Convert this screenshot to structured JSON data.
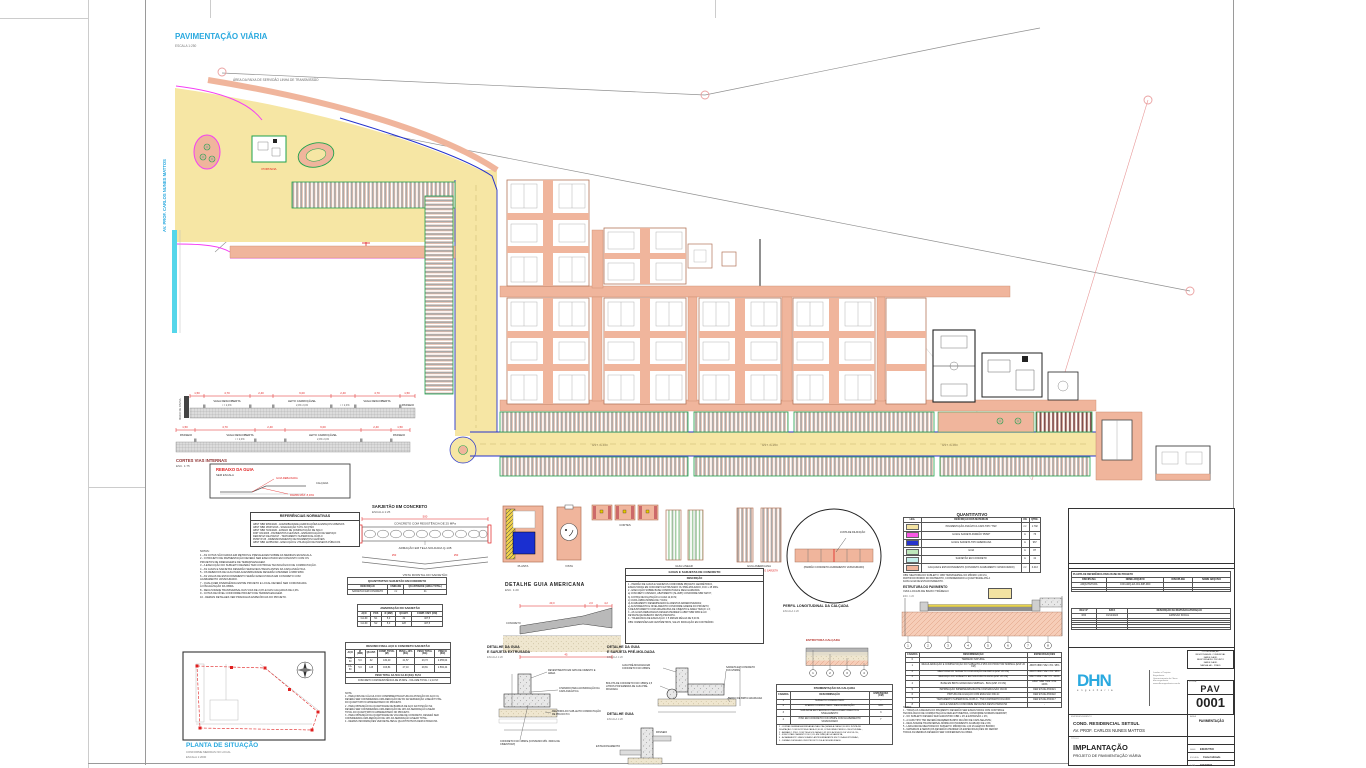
{
  "plan": {
    "title": "PAVIMENTAÇÃO VIÁRIA",
    "scale": "ESCALA 1:250",
    "servidao": "ÁREA DA FAIXA DE SERVIDÃO LINHA DE TRANSMISSÃO",
    "street": "AV. PROF. CARLOS NUNES MATTOS",
    "portaria": "PORTARIA",
    "stations": [
      "EST. 0+100",
      "EST. 0+200",
      "EST. 0+300"
    ]
  },
  "cortes": {
    "title": "CORTES VIAS INTERNAS",
    "scale": "ESC. 1:75",
    "muro": "MURO DE DIVISA",
    "s1_dims": [
      "1,50",
      "4,70",
      "2,40",
      "6,00",
      "2,40",
      "4,70",
      "1,50"
    ],
    "s1_labels": [
      "VAGA DESCOBERTA",
      "LEITO CARROÇÁVEL",
      "VAGA DESCOBERTA",
      "PASSEIO"
    ],
    "s1_slopes": [
      "i = 2,0%",
      "2,0%   2,0%",
      "i = 2,0%"
    ],
    "s2_dims": [
      "1,50",
      "4,70",
      "2,40",
      "6,00",
      "2,40",
      "1,50"
    ],
    "s2_labels": [
      "PASSEIO",
      "VAGA DESCOBERTA",
      "LEITO CARROÇÁVEL",
      "PASSEIO"
    ],
    "s2_slopes": [
      "i = 2,0%",
      "2,0%   2,0%"
    ]
  },
  "rebaixo": {
    "title": "REBAIXO DA GUIA",
    "scale": "SEM ESCALA",
    "l1": "GUIA REBAIXADA",
    "l2": "RAMPA MÁX. 8,33%",
    "l3": "CALÇADA"
  },
  "normas": {
    "title": "REFERÊNCIAS NORMATIVAS",
    "lines": [
      "ABNT NBR 9050/2020 - ACESSIBILIDADE A EDIFICAÇÕES E ESPAÇOS URBANOS",
      "ABNT NBR 16537/2016 - SINALIZAÇÃO TÁTIL NO PISO",
      "ABNT NBR 7182/2020 - ENSAIO DE COMPACTAÇÃO DE SOLO",
      "DNIT 031/2006 - PAVIMENTOS FLEXÍVEIS - ESPECIFICAÇÃO DE SERVIÇO",
      "DER/SP ET-DE-P00/017 - TRATAMENTO SUPERFICIAL DUPLO",
      "PMSP IP-05 - DIMENSIONAMENTO DE PAVIMENTOS FLEXÍVEIS",
      "ABNT NBR 12255/1990 - EXECUÇÃO E UTILIZAÇÃO DE PASSEIOS PÚBLICOS"
    ]
  },
  "notas": {
    "lines": [
      "NOTAS:",
      "1 - AS COTAS SÃO DADAS EM METROS E PREVALECEM SOBRE AS MEDIDAS EM ESCALA.",
      "2 - O PROJETO DE PAVIMENTAÇÃO DEVERÁ SER EXECUTADO EM CONJUNTO COM OS",
      "PROJETOS DE DRENAGEM E DE TERRAPLENAGEM.",
      "3 - A EXECUÇÃO DO SUBLEITO DEVERÁ TER CONTROLE TECNOLÓGICO DE COMPACTAÇÃO.",
      "4 - AS GUIAS E SARJETAS DEVERÃO SER EXECUTADAS ANTES DA CAPA ASFÁLTICA.",
      "5 - OS REBAIXOS DE GUIA PARA ACESSIBILIDADE DEVERÃO ATENDER À NBR 9050.",
      "6 - AS VAGAS DE ESTACIONAMENTO SERÃO EXECUTADAS EM CONCRETO COM",
      "ACABAMENTO VASSOURADO.",
      "7 - QUALQUER DIVERGÊNCIA ENTRE PROJETO E LOCAL DEVERÁ SER COMUNICADA",
      "À FISCALIZAÇÃO DA OBRA.",
      "8 - DECLIVIDADE TRANSVERSAL DAS VIAS DE 2,0% E DAS CALÇADAS DE 2,0%.",
      "9 - COTAS DE NÍVEL CONFORME PROJETO DE TERRAPLENAGEM.",
      "10 - DEMAIS DETALHES VER PRANCHAS ESPECÍFICAS DO PROJETO."
    ]
  },
  "situacao": {
    "title": "PLANTA DE SITUAÇÃO",
    "sub1": "CONFORME MEDIDAS NO LOCAL",
    "sub2": "ESCALA 1:2000"
  },
  "sarjetao": {
    "title": "SARJETÃO EM CONCRETO",
    "scale": "ESCALA 1:25",
    "mat": "CONCRETO COM RESISTÊNCIA DE 25 MPa",
    "arm": "ARMAÇÃO EM TELA SOLDADA Q-138",
    "vista": "VISTA FRONTAL DO SARJETÃO",
    "dim": "500",
    "dim2": "250",
    "dim3": "250",
    "quant": {
      "title": "QUANTITATIVO SARJETÃO EM CONCRETO",
      "cols": [
        "DESCRIÇÃO",
        "UNIDADE",
        "QUANTIDADE (ÁREA TOTAL)"
      ],
      "rows": [
        [
          "SARJETÃO EM CONCRETO",
          "m²",
          "41"
        ]
      ]
    },
    "amarracao": {
      "title": "AMARRAÇÃO DO SARJETÃO",
      "cols": [
        "AÇO",
        "POS",
        "Ø (MM)",
        "QUANT.",
        "COMP. UNIT. (CM)"
      ],
      "rows": [
        [
          "CA-60",
          "N1",
          "5,0",
          "32",
          "407,5"
        ],
        [
          "CA-60",
          "N2",
          "5,0",
          "128",
          "407,5"
        ]
      ]
    },
    "resumo": {
      "title": "RESUMO FINAL AÇO E CONCRETO SARJETÃO",
      "cols": [
        "AÇO",
        "Ø (MM)",
        "QUANT.",
        "COMP. TOTAL (M)",
        "PESO +10% (KG)",
        "PESO TOTAL (KG)",
        "PREÇO (KG)"
      ],
      "rows": [
        [
          "CA-60",
          "5,0",
          "32",
          "130,40",
          "21,57",
          "23,73",
          "2.055,04"
        ],
        [
          "CA-60",
          "5,0",
          "128",
          "163,84",
          "27,10",
          "29,81",
          "2.582,44"
        ]
      ],
      "f1": "PESO TOTAL CA-50 E CA-60 (KG): 53,54",
      "f2": "CONCRETO COM RESISTÊNCIA DE 25 MPa - VOLUME TOTAL = 2,10 M³"
    },
    "notas": [
      "NOTA:",
      "1 - PARA FINS DE CÁLCULO DO COMPRIMENTO/ALTURA DA POSIÇÃO DO AÇO N1,",
      "DEVERÁ SER CONSIDERADA UMA REDUÇÃO DE 5% DA SEPARAÇÃO LINEAR TOTAL",
      "DO QUANTITATIVO APRESENTADO NO PROJETO.",
      "2 - PARA OBTENÇÃO DA QUANTIDADE DE BARRAS DE AÇO DA POSIÇÃO N2,",
      "DEVERÁ SER CONSIDERADA UMA REDUÇÃO DE 10% DA SEPARAÇÃO LINEAR",
      "TOTAL DO QUANTITATIVO APRESENTADO NO PROJETO.",
      "3 - PARA OBTENÇÃO DA QUANTIDADE DE VOLUME DE CONCRETO, DEVERÁ SER",
      "CONSIDERADA UMA REDUÇÃO DE 10% DA SEPARAÇÃO LINEAR TOTAL.",
      "4 - DEMAIS INFORMAÇÕES VER DETALHES E QUANTITATIVOS DESTA PRANCHA."
    ]
  },
  "minis": {
    "labels": [
      "PLANTA",
      "VISTA",
      "CORTES",
      "GUIA LINEAR",
      "GUIA AMERICANA"
    ],
    "sub": "VER DETALHE GUIA E SARJETA"
  },
  "americana": {
    "t1": "DETALHE  GUIA  AMERICANA",
    "t2": "ESC. 1:20",
    "d1": "20,0",
    "d2": "2,0",
    "d3": "4,2",
    "d4": "45",
    "mat": "CONCRETO"
  },
  "specs": {
    "title": "GUIAS E SARJETAS DE CONCRETO",
    "header": "DESCRIÇÃO",
    "lines": [
      "1 - PADRÃO DE GUIAS E SARJETAS CONFORME PROJETO GEOMÉTRICO,",
      "EXECUTADAS EM CONCRETO EXTRUSADO OU PRÉ-MOLDADO, FCK ≥ 25 MPa.",
      "2 - EXECUÇÃO SOBRE BASE COMPACTADA E REGULARIZADA:",
      "a)  CONCRETO USINADO, ABATIMENTO (SLUMP) CONFORME NBR NM 67;",
      "b)  JUNTAS DE DILATAÇÃO A CADA 12,00 M;",
      "c)  CURA ÚMIDA MÍNIMA DE 7 DIAS;",
      "d)  ACABAMENTO DESEMPENADO E ARESTAS ARREDONDADAS;",
      "e)  ALINHAMENTO E NIVELAMENTO CONFORME GREIDE DO PROJETO;",
      "f)  REJUNTAMENTO COM ARGAMASSA DE CIMENTO E AREIA TRAÇO 1:3;",
      "3 - AS GUIAS REBAIXADAS DEVEM ATENDER À ABNT NBR 9050 E AO",
      "DETALHE DE REBAIXO DESTA PRANCHA.",
      "4 - TOLERÂNCIA DE EXECUÇÃO: ± 5 MM EM RÉGUA DE 5,00 M.",
      "OBS: DIMENSÕES EM CENTÍMETROS, SALVO INDICAÇÃO EM CONTRÁRIO."
    ]
  },
  "extrusada": {
    "t1": "DETALHE DA GUIA",
    "t2": "E SARJETA EXTRUSADA",
    "t3": "ESCALA 1:20",
    "l1": "REVESTIMENTO EM NATA DE CIMENTO E AREIA",
    "l2": "CHANFRO PARA ACOMODAÇÃO DA CAPA ASFÁLTICA",
    "l3": "MELHORIA DO SUB-LEITO COMPACTAÇÃO DE 95% DO P.N.",
    "l4": "CONCRETO FCK=15MPa (CONSUMO MÍN. 300KG DE CIMENTO/M³)"
  },
  "premoldada": {
    "t1": "DETALHE DA GUIA",
    "t2": "E SARJETA PRÉ-MOLDADA",
    "t3": "ESCALA 1:20",
    "l1": "GUIA PRÉ-MOLDADA EM CONCRETO FCK=25MPa",
    "l2": "SARJETA EM CONCRETO FCK=25MPa",
    "l3": "BOLOTA DE CONCRETO FCK=15MPa 2,5 LITROS POR EMENDA DE GUIA PRÉ-MOLDADA",
    "l4": "BERÇO DE BRITA GRADUADA"
  },
  "guia": {
    "t1": "DETALHE GUIA",
    "t2": "ESCALA 1:20",
    "l1": "PASSEIO",
    "l2": "ESTACIONAMENTO"
  },
  "perfil": {
    "t1": "PERFIL LONGITUDINAL DA CALÇADA",
    "t2": "ESCALA 1:20",
    "l1": "JUNTA DE DILATAÇÃO",
    "l2": "(PADRÃO CONCRETO ACABAMENTO VASSOURADO)"
  },
  "calcada": {
    "title": "ESTRUTURA CALÇADA",
    "callouts": [
      "1",
      "2",
      "3",
      "4"
    ],
    "table": {
      "title": "PAVIMENTAÇÃO DA CALÇADA",
      "cols": [
        "CAMADA",
        "DESCRIMINAÇÃO",
        "ESPESSURA (CM)"
      ],
      "rows": [
        [
          "1",
          "SUBLEITO COMPACTADO",
          "-"
        ],
        [
          "2",
          "ATERRO COMPACTADO / REGULARIZAÇÃO",
          "VAR."
        ],
        [
          "3",
          "SUB-BASE EM PEDRISCO PARA ASSENTAMENTO E NIVELAMENTO",
          "3"
        ],
        [
          "4",
          "PISO EM CONCRETO FCK=25MPa COM ACABAMENTO VASSOURADO",
          "7"
        ]
      ]
    },
    "notas": [
      "1 - JUNTAS SERRADAS/FRISADAS NAS CALÇADAS A CADA 2,00 M E JUNTA DE",
      "DILATAÇÃO COM ISOPOR A CADA 12,00 M, CONFORME PERFIL LONGITUDINAL;",
      "2 - ARMAR O PISO COM TELA SOLDADA Q-92 NOS ACESSOS DE VEÍCULOS;",
      "3 - EXECUTAR CAIMENTO DE 2,0% EM DIREÇÃO À SARJETA;",
      "4 - ACABAMENTO VASSOURADO ANTIDERRAPANTE EM TODA A EXTENSÃO;",
      "5 - DEMAIS DETALHES VER PROJETO DE ACESSIBILIDADE."
    ]
  },
  "quantitativo": {
    "title": "QUANTITATIVO",
    "cols": [
      "LEG.",
      "DESCRIÇÃO DOS MATERIAIS",
      "UN.",
      "QTDE."
    ],
    "rows": [
      [
        "#f3e3a2",
        "PAVIMENTAÇÃO ASFÁLTICA CAPA TIPO 'TSD'",
        "m²",
        "1.792"
      ],
      [
        "#f857e4",
        "GUIA E SARJETA PADRÃO 'PMSP'",
        "m",
        "76"
      ],
      [
        "#2633cc",
        "GUIA E SARJETA TIPO AMERICANA",
        "m",
        "967"
      ],
      [
        "#bfe8bc",
        "GUIA",
        "m",
        "87"
      ],
      [
        "#c4f0ec",
        "SARJETÃO EM CONCRETO",
        "m",
        "41"
      ],
      [
        "#f0b59c",
        "CALÇADA E ESTACIONAMENTO (CONCRETO ACABAMENTO VASSOURADO)",
        "m²",
        "3.413"
      ]
    ],
    "obs": [
      "OBS: MELHORIA DO SUBLEITO: CBR TRANSVERSAL NO MÍNIMO 1,00 M A",
      "PARTIR DO BORDO DO PAVIMENTO, CONSIDERANDO A QUANTIDADE ATÉ A",
      "FAIXA GUIA DE ESTACIONAMENTO."
    ]
  },
  "pavimento": {
    "t1": "ESTRUTURA DO PAVIMENTO",
    "t2": "VIAS LOCAIS DE BAIXO TRÁFEGO",
    "t3": "ESC. 1:20",
    "callouts": [
      "1",
      "2",
      "3",
      "4",
      "5",
      "6",
      "7",
      "8"
    ],
    "table": {
      "cols": [
        "CAMADA",
        "DESCRIMINAÇÃO",
        "ESPECIFICAÇÕES"
      ],
      "rows": [
        [
          "0",
          "TERRENO NATURAL",
          "-"
        ],
        [
          "1",
          "REGULARIZAÇÃO E COMPACTAÇÃO DO SUBLEITO A 95% DO PROCTOR NORMAL (ESP. 20 CM)",
          "ABNT NBR 7182 / P.N. 95%"
        ],
        [
          "2",
          "MELHORIA DO SUBLEITO COM ADIÇÃO DE BRITA (ESP. 20 CM)",
          "ABNT NBR 7182 / P.N. 95%"
        ],
        [
          "3",
          "REFORÇO DO SUBLEITO EM SOLO-BRITA 40/60 (ESP. 20 CM)",
          "ABNT NBR 7182 / P.I. 100%"
        ],
        [
          "4",
          "BASE EM BRITA GRADUADA SIMPLES - BGS (ESP. 15 CM)",
          "ABNT NBR 7182 / P.M. 100%"
        ],
        [
          "5",
          "IMPRIMAÇÃO IMPERMEABILIZANTE COM EMULSÃO CM-30",
          "DER ET-DE-P00/021"
        ],
        [
          "6",
          "PINTURA DE LIGAÇÃO COM EMULSÃO RR-1C",
          "DER ET-DE-P00/022"
        ],
        [
          "7",
          "TRATAMENTO SUPERFICIAL DUPLO - TSD COM BANHO DILUÍDO",
          "DER ET-DE-P00/017"
        ],
        [
          "8",
          "GUIA E SARJETA CONFORME DETALHES DESTA PRANCHA",
          "-"
        ]
      ]
    },
    "notas": [
      "NOTAS:",
      "1 - TODAS AS CAMADAS DO PAVIMENTO DEVERÃO SER EXECUTADAS COM CONTROLE",
      "TECNOLÓGICO DE COMPACTAÇÃO E DEFLECTOMETRIA, CONFORME NORMAS DER/DNIT;",
      "2 - NO SUBLEITO DEVERÁ SER GARANTIDO CBR ≥ 2% E EXPANSÃO ≤ 2%;",
      "3 - A CAPA TIPO TSD DEVERÁ RECEBER BANHO DILUÍDO DE CAPA SELANTE;",
      "4 - DECLIVIDADE TRANSVERSAL MÍNIMA DO PAVIMENTO ACABADO DE 2,0%;",
      "5 - LARGURA DE MELHORIA DO SUBLEITO: MÍNIMO DE 1,00 M ALÉM DO BORDO;",
      "6 - MATERIAIS E SERVIÇOS DEVERÃO ATENDER ÀS ESPECIFICAÇÕES DO DER/SP.",
      "TODAS AS MEDIDAS DEVERÃO SER CONFERIDAS NA OBRA."
    ]
  },
  "titleblock": {
    "ref": {
      "title": "PLANTA DE REFERÊNCIA PARA BASE DE PROJETO",
      "cols": [
        "DISCIPLINA",
        "NOME ARQUIVO",
        "DISCIPLINA",
        "NOME ARQUIVO"
      ],
      "rows": [
        [
          "ARQUITETURA",
          "CON-ARQ-EX-001-IMP-R00",
          "",
          ""
        ],
        [
          "",
          "",
          "",
          ""
        ],
        [
          "",
          "",
          "",
          ""
        ]
      ]
    },
    "rev": {
      "cols": [
        "REV. Nº",
        "DATA",
        "DESCRIÇÃO DA REVISÃO/ALTERAÇÃO"
      ],
      "rows": [
        [
          "R00",
          "19/12/2024",
          "EMISSÃO INICIAL"
        ],
        [
          "",
          "",
          ""
        ],
        [
          "",
          "",
          ""
        ],
        [
          "",
          "",
          ""
        ],
        [
          "",
          "",
          ""
        ],
        [
          "",
          "",
          ""
        ]
      ]
    },
    "logo": "DHN",
    "logo_sub": "engenharia",
    "contact": [
      "Laudos e Projetos",
      "Engenharia",
      "Gerenciamento de Obras",
      "dhn.engenharia",
      "www.dhnengenharia.com.br"
    ],
    "team": [
      "COORDENAÇÃO",
      "RESPONSÁVEL COMERCIAL",
      "NAIDE DAUD",
      "RESPONSÁVEL PROJETO",
      "NAIDE DAUD",
      "NATHALIA L. PINED"
    ],
    "folha_label": "FOLHA",
    "num1": "PAV",
    "num2": "0001",
    "emp_label": "EMPREENDIMENTO",
    "emp1": "COND. RESIDENCIAL SETSUL",
    "emp2": "AV. PROF. CARLOS NUNES MATTOS",
    "area_label": "ÁREA",
    "area": "PAVIMENTAÇÃO",
    "tit_label": "TÍTULO",
    "tit1": "IMPLANTAÇÃO",
    "tit2": "PROJETO DE PAVIMENTAÇÃO VIÁRIA",
    "fields": [
      {
        "l": "FASE",
        "v": "EXECUTIVO"
      },
      {
        "l": "ESCALA",
        "v": "Como Indicado"
      },
      {
        "l": "DATA",
        "v": "19/12/2024"
      },
      {
        "l": "REVISÃO",
        "v": "R00"
      }
    ]
  }
}
